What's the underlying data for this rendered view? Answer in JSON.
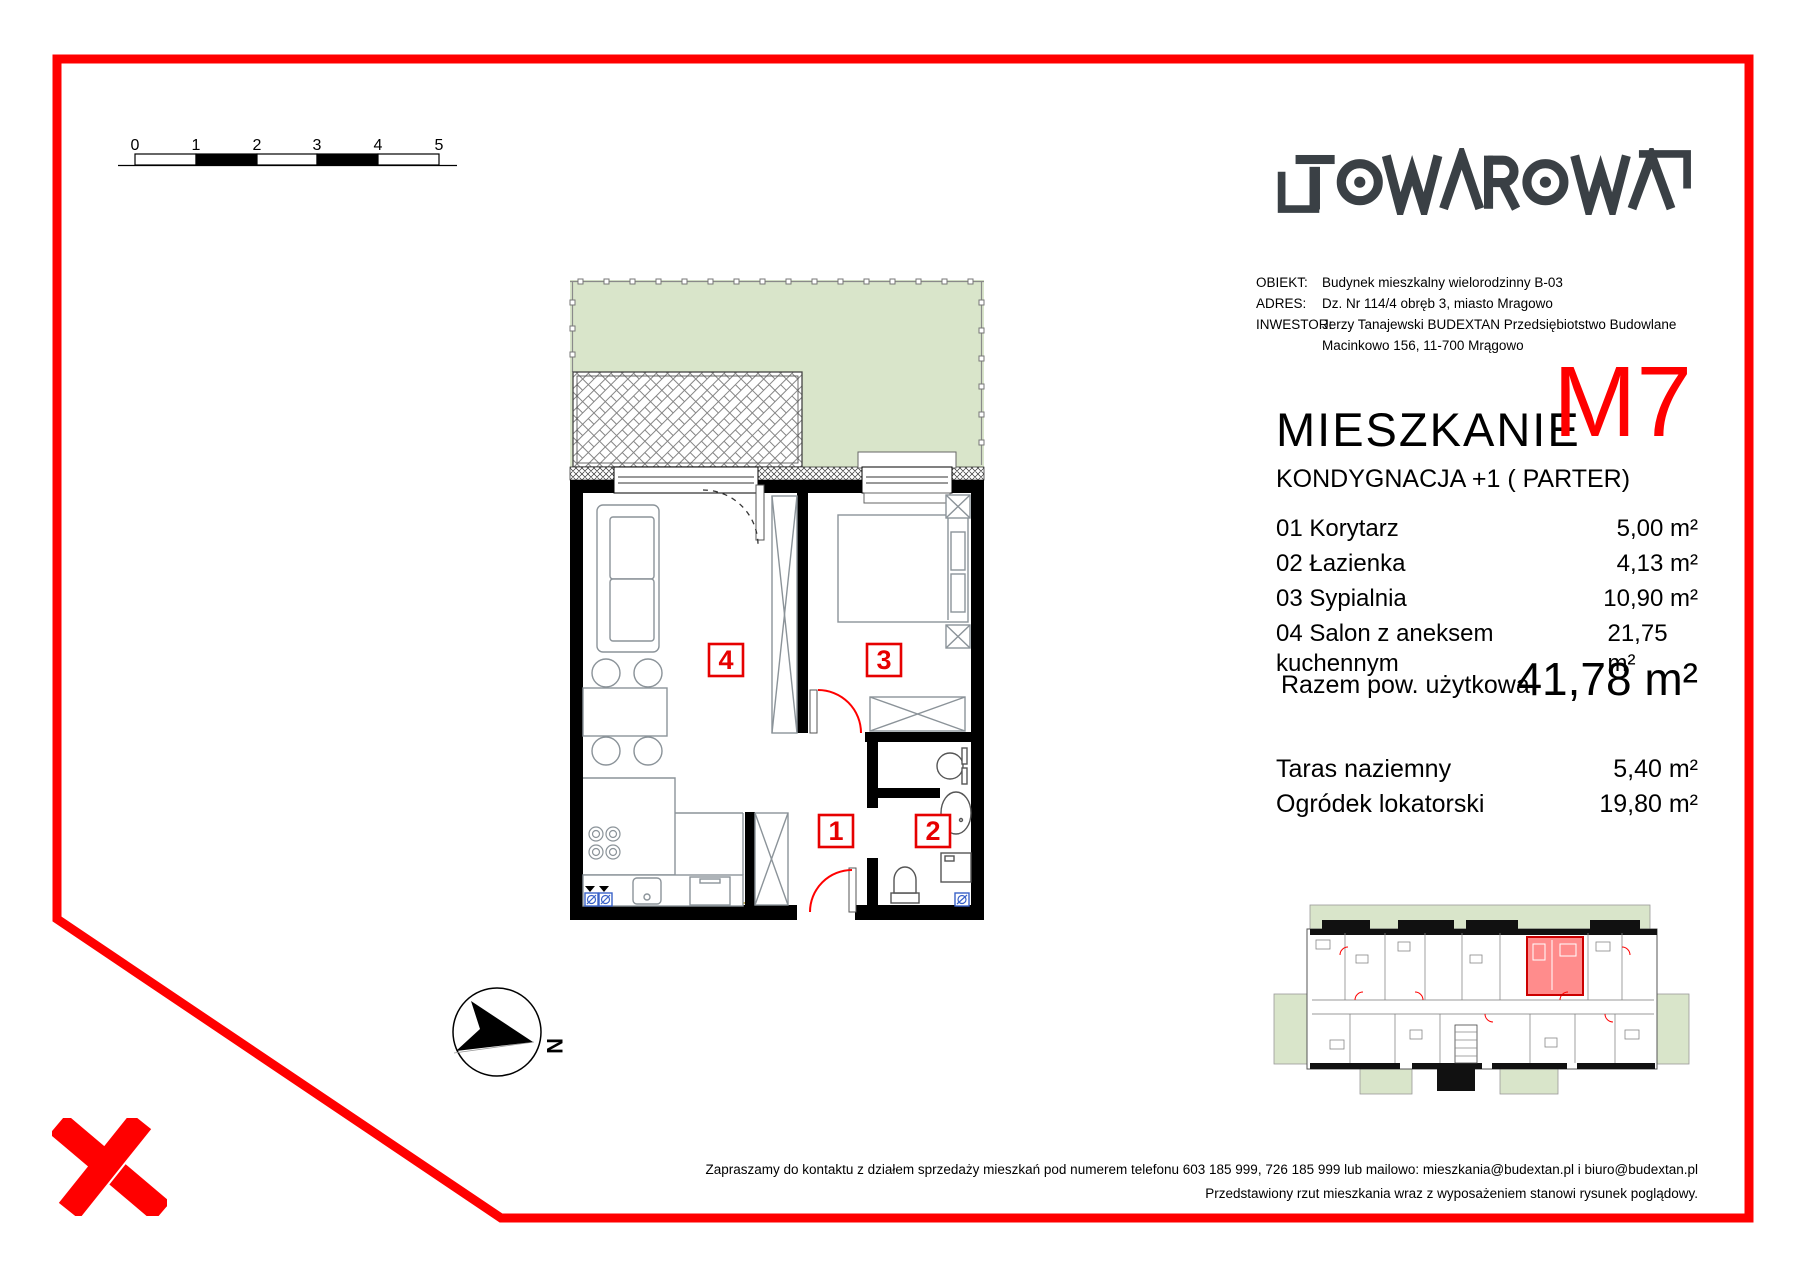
{
  "scale_bar": {
    "ticks": [
      "0",
      "1",
      "2",
      "3",
      "4",
      "5"
    ]
  },
  "logo": {
    "text": "TOWAROWA"
  },
  "project_info": {
    "rows": [
      {
        "label": "OBIEKT:",
        "value": "Budynek mieszkalny wielorodzinny B-03"
      },
      {
        "label": "ADRES:",
        "value": "Dz. Nr 114/4 obręb 3, miasto Mragowo"
      },
      {
        "label": "INWESTOR:",
        "value": "Jerzy Tanajewski BUDEXTAN Przedsiębiotstwo Budowlane"
      },
      {
        "label": "",
        "value": "Macinkowo 156, 11-700 Mrągowo"
      }
    ]
  },
  "title": {
    "name": "MIESZKANIE",
    "unit": "M7",
    "floor": "KONDYGNACJA +1  ( PARTER)"
  },
  "rooms": [
    {
      "name": "01 Korytarz",
      "area": "5,00 m²"
    },
    {
      "name": "02 Łazienka",
      "area": "4,13 m²"
    },
    {
      "name": "03 Sypialnia",
      "area": "10,90 m²"
    },
    {
      "name": "04 Salon z aneksem kuchennym",
      "area": "21,75 m²"
    }
  ],
  "summary": {
    "label": "Razem pow. użytkowa",
    "value": "41,78 m²"
  },
  "outdoor": [
    {
      "label": "Taras naziemny",
      "value": "5,40 m²"
    },
    {
      "label": "Ogródek lokatorski",
      "value": "19,80 m²"
    }
  ],
  "plan": {
    "labels": {
      "salon": "4",
      "sypialnia": "3",
      "korytarz": "1",
      "lazienka": "2"
    },
    "compass": "N"
  },
  "footer": {
    "line1": "Zapraszamy do kontaktu z działem sprzedaży mieszkań pod numerem telefonu 603 185 999, 726 185 999 lub mailowo: mieszkania@budextan.pl i biuro@budextan.pl",
    "line2": "Przedstawiony rzut mieszkania wraz z wyposażeniem stanowi rysunek poglądowy."
  },
  "colors": {
    "accent_red": "#ff0000",
    "garden_green": "#d9e5ca",
    "logo_dark": "#3a4045",
    "shaft_blue": "#3a62c8"
  }
}
